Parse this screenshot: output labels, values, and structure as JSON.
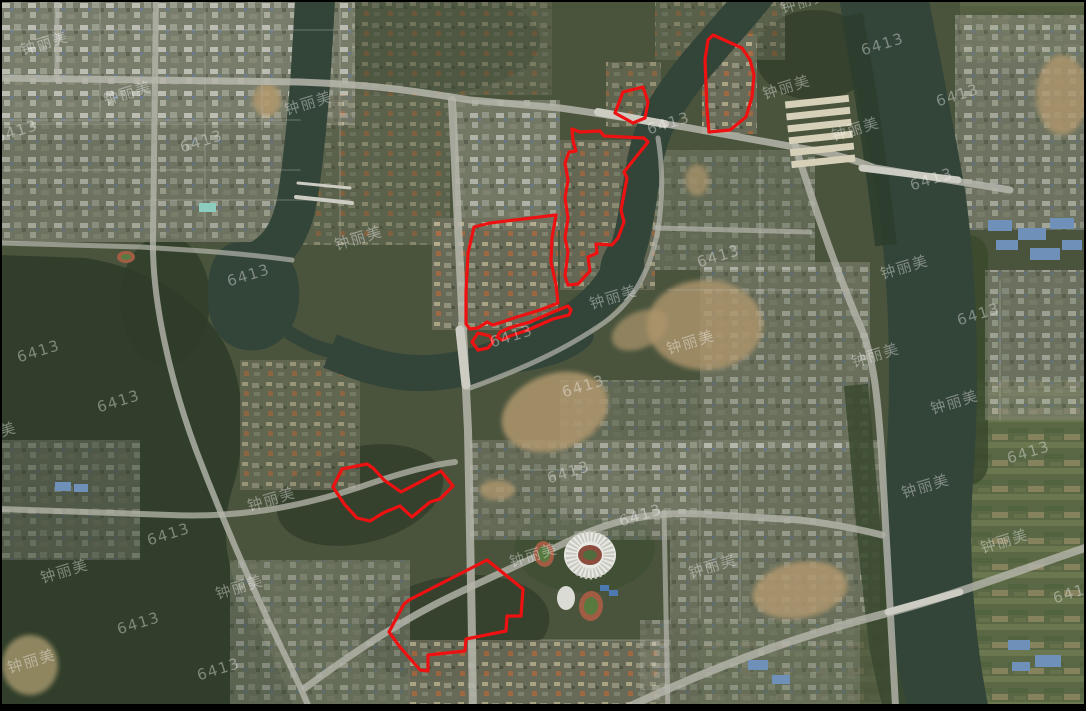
{
  "map": {
    "type": "satellite-imagery",
    "colors": {
      "frame": "#000000",
      "base_terrain": "#47523a",
      "forest": "#2c3a26",
      "water": "#2f4136",
      "road": "#bcbcb2",
      "dirt": "#b49a6e",
      "zone_stroke": "#ee1111",
      "watermark": "rgba(255,255,255,0.38)"
    },
    "watermark_texts": [
      "钟丽美",
      "6413"
    ],
    "red_zones": [
      {
        "name": "northeast",
        "points": [
          [
            713,
            35
          ],
          [
            742,
            48
          ],
          [
            750,
            60
          ],
          [
            754,
            75
          ],
          [
            752,
            97
          ],
          [
            746,
            117
          ],
          [
            730,
            130
          ],
          [
            709,
            132
          ],
          [
            707,
            110
          ],
          [
            705,
            60
          ],
          [
            708,
            40
          ]
        ]
      },
      {
        "name": "north-small",
        "points": [
          [
            623,
            92
          ],
          [
            643,
            87
          ],
          [
            648,
            102
          ],
          [
            645,
            118
          ],
          [
            633,
            123
          ],
          [
            615,
            113
          ]
        ]
      },
      {
        "name": "center-tall",
        "points": [
          [
            572,
            129
          ],
          [
            580,
            132
          ],
          [
            600,
            131
          ],
          [
            604,
            136
          ],
          [
            644,
            138
          ],
          [
            648,
            142
          ],
          [
            624,
            172
          ],
          [
            627,
            178
          ],
          [
            621,
            210
          ],
          [
            624,
            222
          ],
          [
            618,
            238
          ],
          [
            612,
            245
          ],
          [
            596,
            244
          ],
          [
            597,
            253
          ],
          [
            588,
            257
          ],
          [
            590,
            271
          ],
          [
            578,
            284
          ],
          [
            568,
            285
          ],
          [
            565,
            276
          ],
          [
            568,
            252
          ],
          [
            565,
            238
          ],
          [
            568,
            218
          ],
          [
            565,
            198
          ],
          [
            568,
            180
          ],
          [
            565,
            163
          ],
          [
            569,
            152
          ],
          [
            576,
            151
          ],
          [
            573,
            141
          ]
        ]
      },
      {
        "name": "center-left",
        "points": [
          [
            474,
            227
          ],
          [
            490,
            223
          ],
          [
            556,
            215
          ],
          [
            552,
            238
          ],
          [
            551,
            262
          ],
          [
            556,
            285
          ],
          [
            558,
            303
          ],
          [
            540,
            310
          ],
          [
            517,
            317
          ],
          [
            493,
            325
          ],
          [
            487,
            322
          ],
          [
            478,
            328
          ],
          [
            470,
            329
          ],
          [
            466,
            324
          ],
          [
            466,
            292
          ],
          [
            468,
            253
          ]
        ]
      },
      {
        "name": "riverbank-strip",
        "points": [
          [
            500,
            332
          ],
          [
            512,
            327
          ],
          [
            530,
            322
          ],
          [
            553,
            312
          ],
          [
            568,
            306
          ],
          [
            571,
            310
          ],
          [
            569,
            315
          ],
          [
            553,
            319
          ],
          [
            528,
            330
          ],
          [
            510,
            336
          ],
          [
            502,
            340
          ],
          [
            497,
            337
          ]
        ]
      },
      {
        "name": "riverbank-blob",
        "points": [
          [
            478,
            333
          ],
          [
            490,
            336
          ],
          [
            493,
            342
          ],
          [
            488,
            348
          ],
          [
            478,
            350
          ],
          [
            472,
            342
          ]
        ]
      },
      {
        "name": "southwest",
        "points": [
          [
            333,
            487
          ],
          [
            342,
            469
          ],
          [
            367,
            464
          ],
          [
            373,
            468
          ],
          [
            384,
            480
          ],
          [
            401,
            492
          ],
          [
            441,
            471
          ],
          [
            453,
            486
          ],
          [
            440,
            499
          ],
          [
            430,
            502
          ],
          [
            412,
            517
          ],
          [
            400,
            506
          ],
          [
            385,
            512
          ],
          [
            370,
            521
          ],
          [
            357,
            518
          ],
          [
            345,
            505
          ]
        ]
      },
      {
        "name": "south",
        "points": [
          [
            487,
            560
          ],
          [
            523,
            589
          ],
          [
            521,
            616
          ],
          [
            507,
            616
          ],
          [
            506,
            631
          ],
          [
            466,
            639
          ],
          [
            465,
            651
          ],
          [
            428,
            655
          ],
          [
            428,
            671
          ],
          [
            420,
            670
          ],
          [
            400,
            647
          ],
          [
            389,
            632
          ],
          [
            404,
            604
          ],
          [
            409,
            600
          ]
        ]
      }
    ],
    "watermarks": [
      {
        "t": "钟丽美",
        "x": 46,
        "y": 48
      },
      {
        "t": "钟丽美",
        "x": 129,
        "y": 98
      },
      {
        "t": "钟丽美",
        "x": 310,
        "y": 108
      },
      {
        "t": "钟丽美",
        "x": 360,
        "y": 243
      },
      {
        "t": "钟丽美",
        "x": 615,
        "y": 302
      },
      {
        "t": "钟丽美",
        "x": 906,
        "y": 272
      },
      {
        "t": "钟丽美",
        "x": 788,
        "y": 92
      },
      {
        "t": "钟丽美",
        "x": 857,
        "y": 134
      },
      {
        "t": "钟丽美",
        "x": 806,
        "y": 6
      },
      {
        "t": "钟丽美",
        "x": 956,
        "y": 407
      },
      {
        "t": "钟丽美",
        "x": 927,
        "y": 491
      },
      {
        "t": "钟丽美",
        "x": 1006,
        "y": 546
      },
      {
        "t": "钟丽美",
        "x": 535,
        "y": 560
      },
      {
        "t": "钟丽美",
        "x": 714,
        "y": 571
      },
      {
        "t": "钟丽美",
        "x": 66,
        "y": 576
      },
      {
        "t": "钟丽美",
        "x": 241,
        "y": 592
      },
      {
        "t": "钟丽美",
        "x": 273,
        "y": 504
      },
      {
        "t": "钟丽美",
        "x": 33,
        "y": 666
      },
      {
        "t": "钟丽美",
        "x": 692,
        "y": 347
      },
      {
        "t": "钟丽美",
        "x": 877,
        "y": 360
      },
      {
        "t": "钟丽美",
        "x": -6,
        "y": 439
      },
      {
        "t": "6413",
        "x": 203,
        "y": 146
      },
      {
        "t": "6413",
        "x": 18,
        "y": 136
      },
      {
        "t": "6413",
        "x": 250,
        "y": 280
      },
      {
        "t": "6413",
        "x": 40,
        "y": 356
      },
      {
        "t": "6413",
        "x": 120,
        "y": 406
      },
      {
        "t": "6413",
        "x": 720,
        "y": 261
      },
      {
        "t": "6413",
        "x": 670,
        "y": 128
      },
      {
        "t": "6413",
        "x": 513,
        "y": 341
      },
      {
        "t": "6413",
        "x": 570,
        "y": 477
      },
      {
        "t": "6413",
        "x": 585,
        "y": 391
      },
      {
        "t": "6413",
        "x": 642,
        "y": 520
      },
      {
        "t": "6413",
        "x": 170,
        "y": 539
      },
      {
        "t": "6413",
        "x": 140,
        "y": 628
      },
      {
        "t": "6413",
        "x": 220,
        "y": 674
      },
      {
        "t": "6413",
        "x": 884,
        "y": 49
      },
      {
        "t": "6413",
        "x": 959,
        "y": 100
      },
      {
        "t": "6413",
        "x": 933,
        "y": 184
      },
      {
        "t": "6413",
        "x": 980,
        "y": 319
      },
      {
        "t": "6413",
        "x": 1030,
        "y": 457
      },
      {
        "t": "6413",
        "x": 1076,
        "y": 597
      }
    ]
  }
}
